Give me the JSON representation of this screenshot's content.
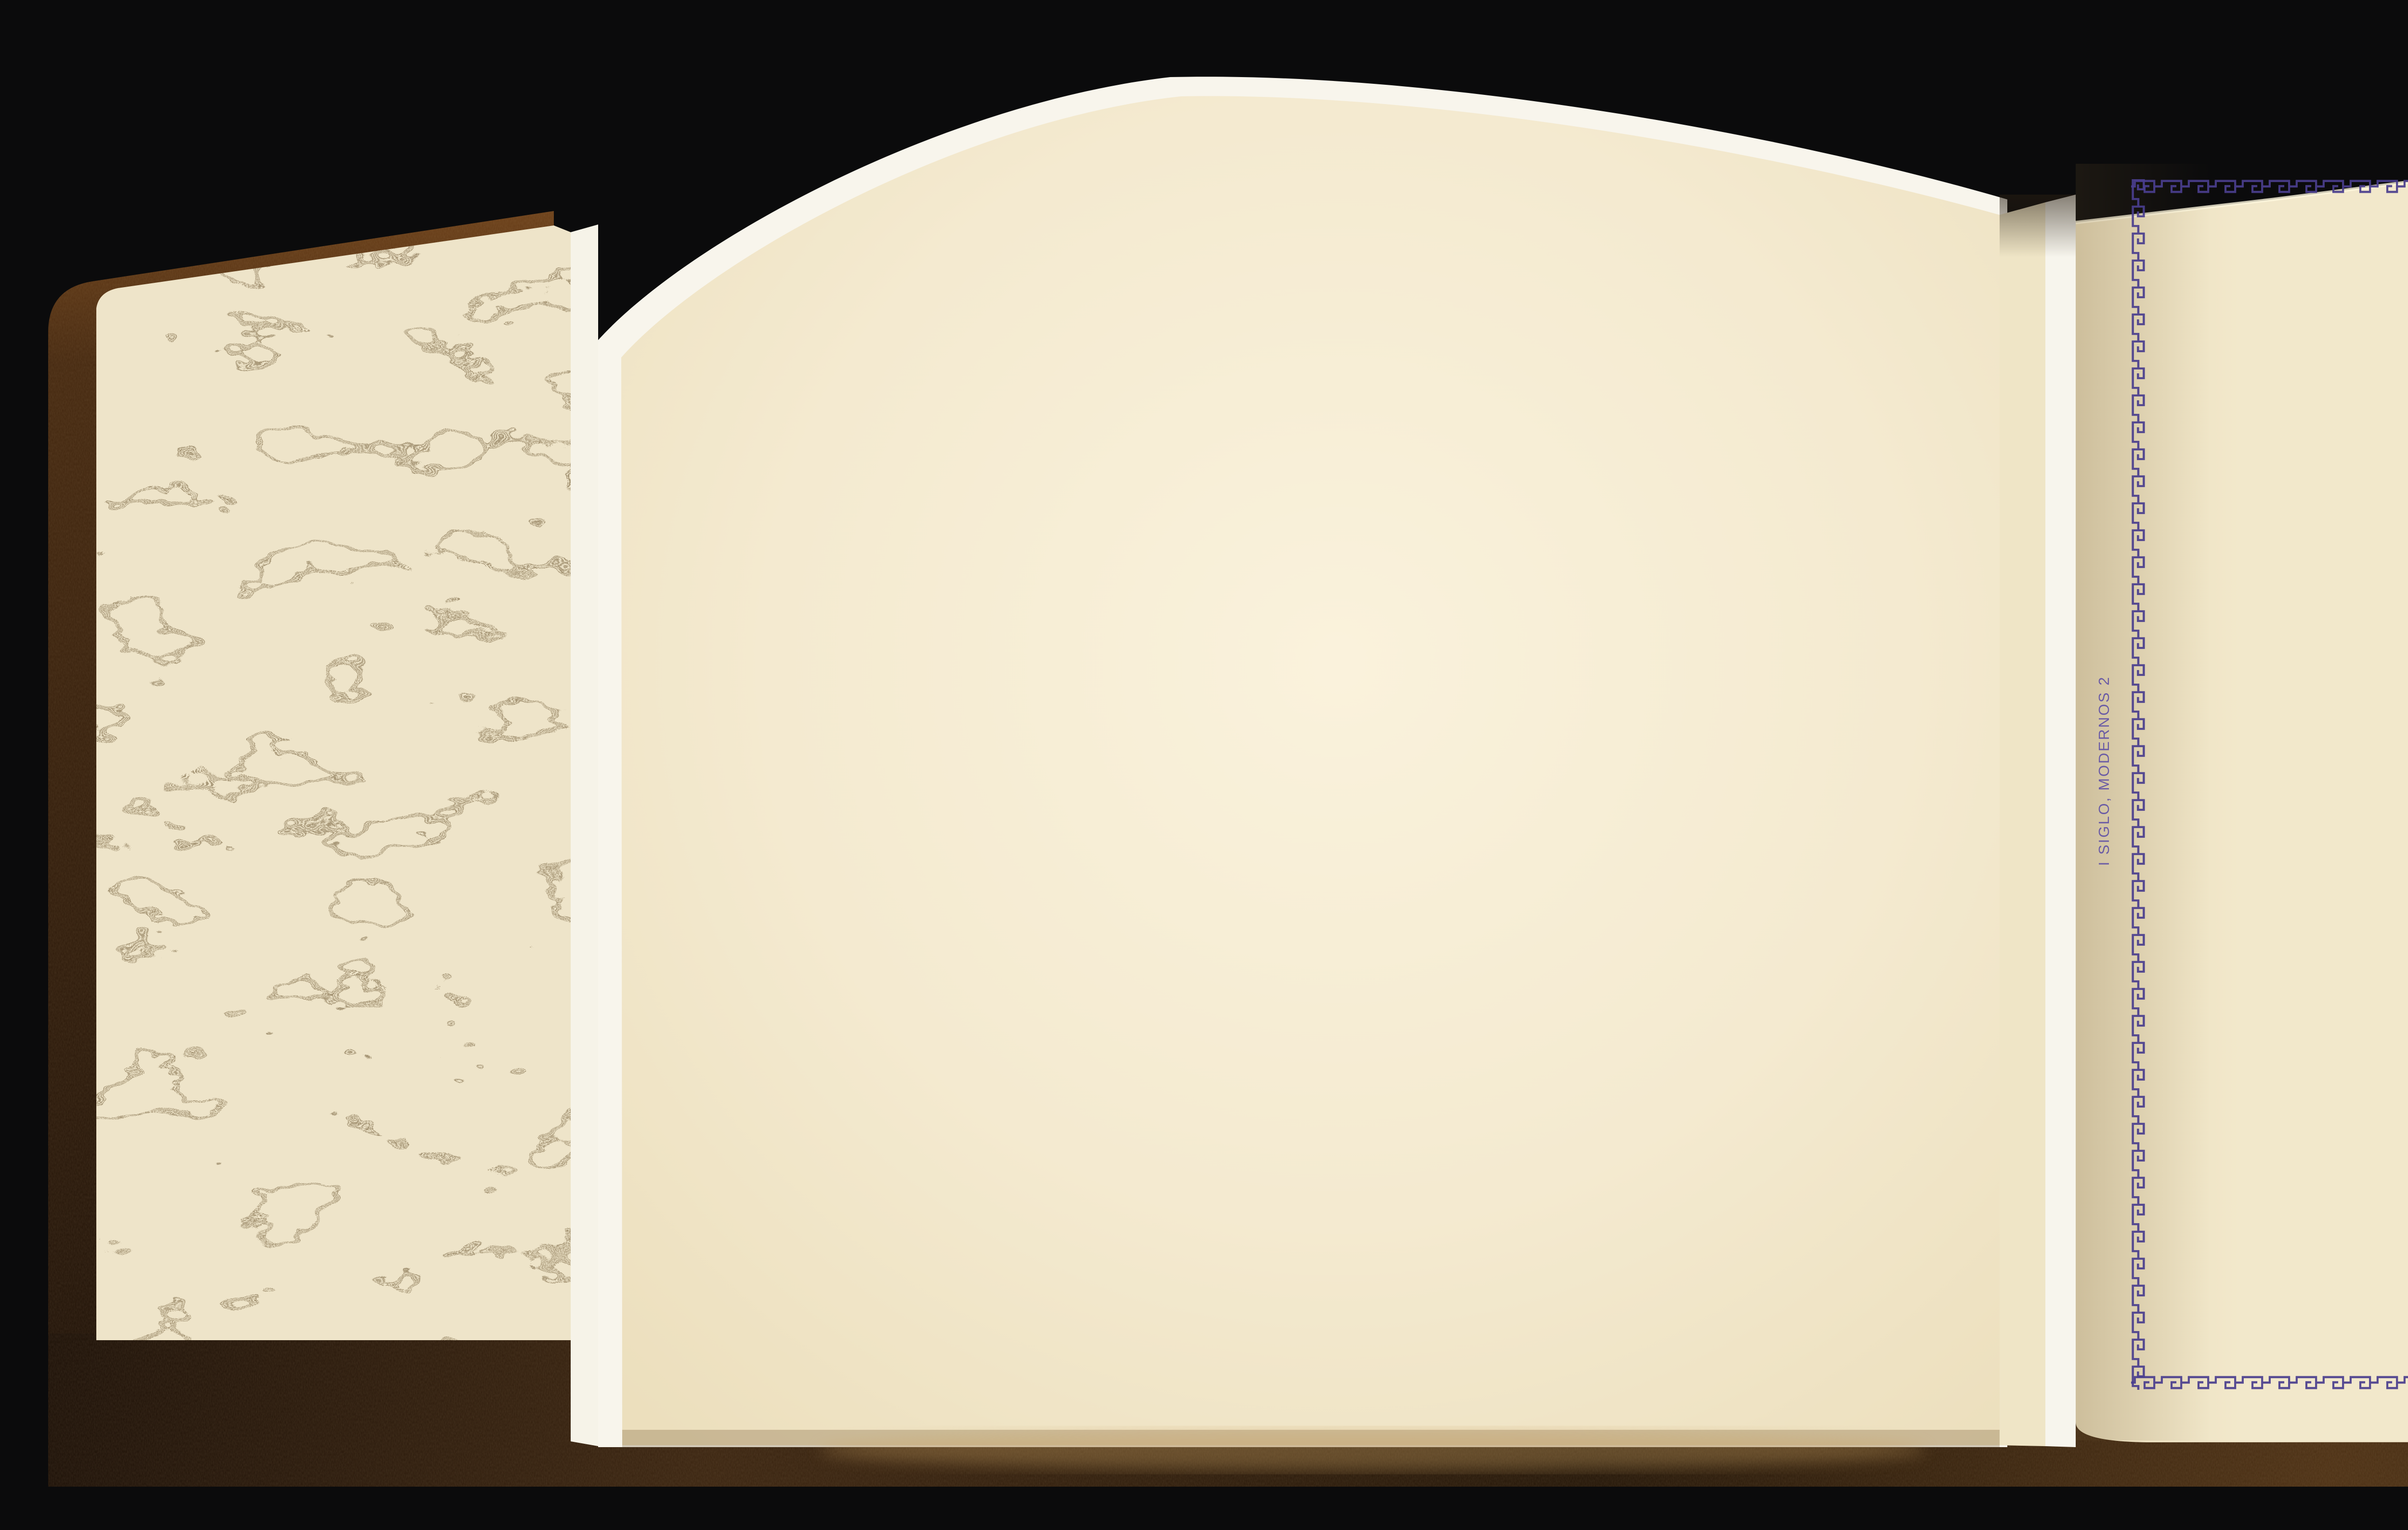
{
  "album_page": {
    "country_title": "ESPAÑA",
    "sections": [
      {
        "caption": "1897, Cifra. Impuesto de guerra.",
        "stamp_slots": [
          "5 Cts.",
          "10 Cts.",
          "15 Cts.",
          "20 Cts."
        ]
      },
      {
        "caption": "1898",
        "stamp_slots": [
          "5 Cts.",
          "10",
          "",
          "20 Cts."
        ]
      },
      {
        "caption": "Alfonso XIII. Impuesto de guerra.",
        "stamp_slots": [
          ""
        ]
      }
    ],
    "margin_note": "I SIGLO, MODERNOS 2"
  },
  "colors": {
    "ink_purple": "#4a3e8e",
    "album_sheet_cream": "#f2e8cb",
    "blank_page_cream": "#f4ecd4",
    "marbled_base": "#eee4c9",
    "marbled_swirl": "#a39272",
    "leather_brown": "#4a2c12",
    "backdrop_black": "#0b0b0c"
  }
}
